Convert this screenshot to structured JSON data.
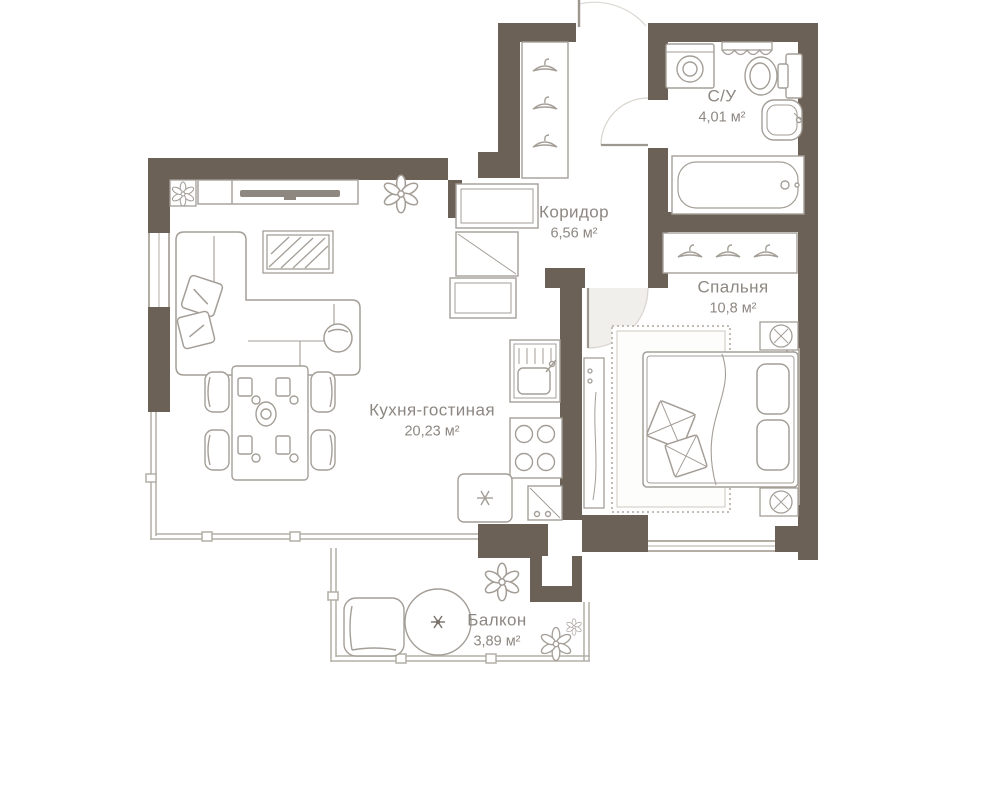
{
  "colors": {
    "wall": "#6c6156",
    "furniture_line": "#a49e97",
    "window_line": "#b3ada6",
    "label_text": "#8d8781",
    "background": "#ffffff"
  },
  "rooms": {
    "corridor": {
      "name": "Коридор",
      "area": "6,56 м²"
    },
    "bathroom": {
      "name": "С/У",
      "area": "4,01 м²"
    },
    "bedroom": {
      "name": "Спальня",
      "area": "10,8 м²"
    },
    "kitchen_living": {
      "name": "Кухня-гостиная",
      "area": "20,23 м²"
    },
    "balcony": {
      "name": "Балкон",
      "area": "3,89 м²"
    }
  },
  "icons": [
    "sofa",
    "tv-console",
    "wall-art",
    "dining-table",
    "dining-chair",
    "place-setting",
    "corner-plant",
    "hall-plant",
    "entry-wardrobe",
    "coat-hanger",
    "washing-machine",
    "bathroom-shelf",
    "toilet",
    "bathroom-sink",
    "bathtub",
    "bedroom-wardrobe",
    "bed",
    "pillow",
    "nightstand-lamp",
    "bedroom-rug",
    "tall-cabinet",
    "kitchen-upper-cabinets",
    "kitchen-counter",
    "kitchen-sink",
    "stove",
    "kitchen-lower-cabinet",
    "plant-table",
    "balcony-beanbag",
    "balcony-pouf",
    "flower",
    "entrance-door",
    "bathroom-door",
    "bedroom-door",
    "window",
    "panoramic-window"
  ]
}
